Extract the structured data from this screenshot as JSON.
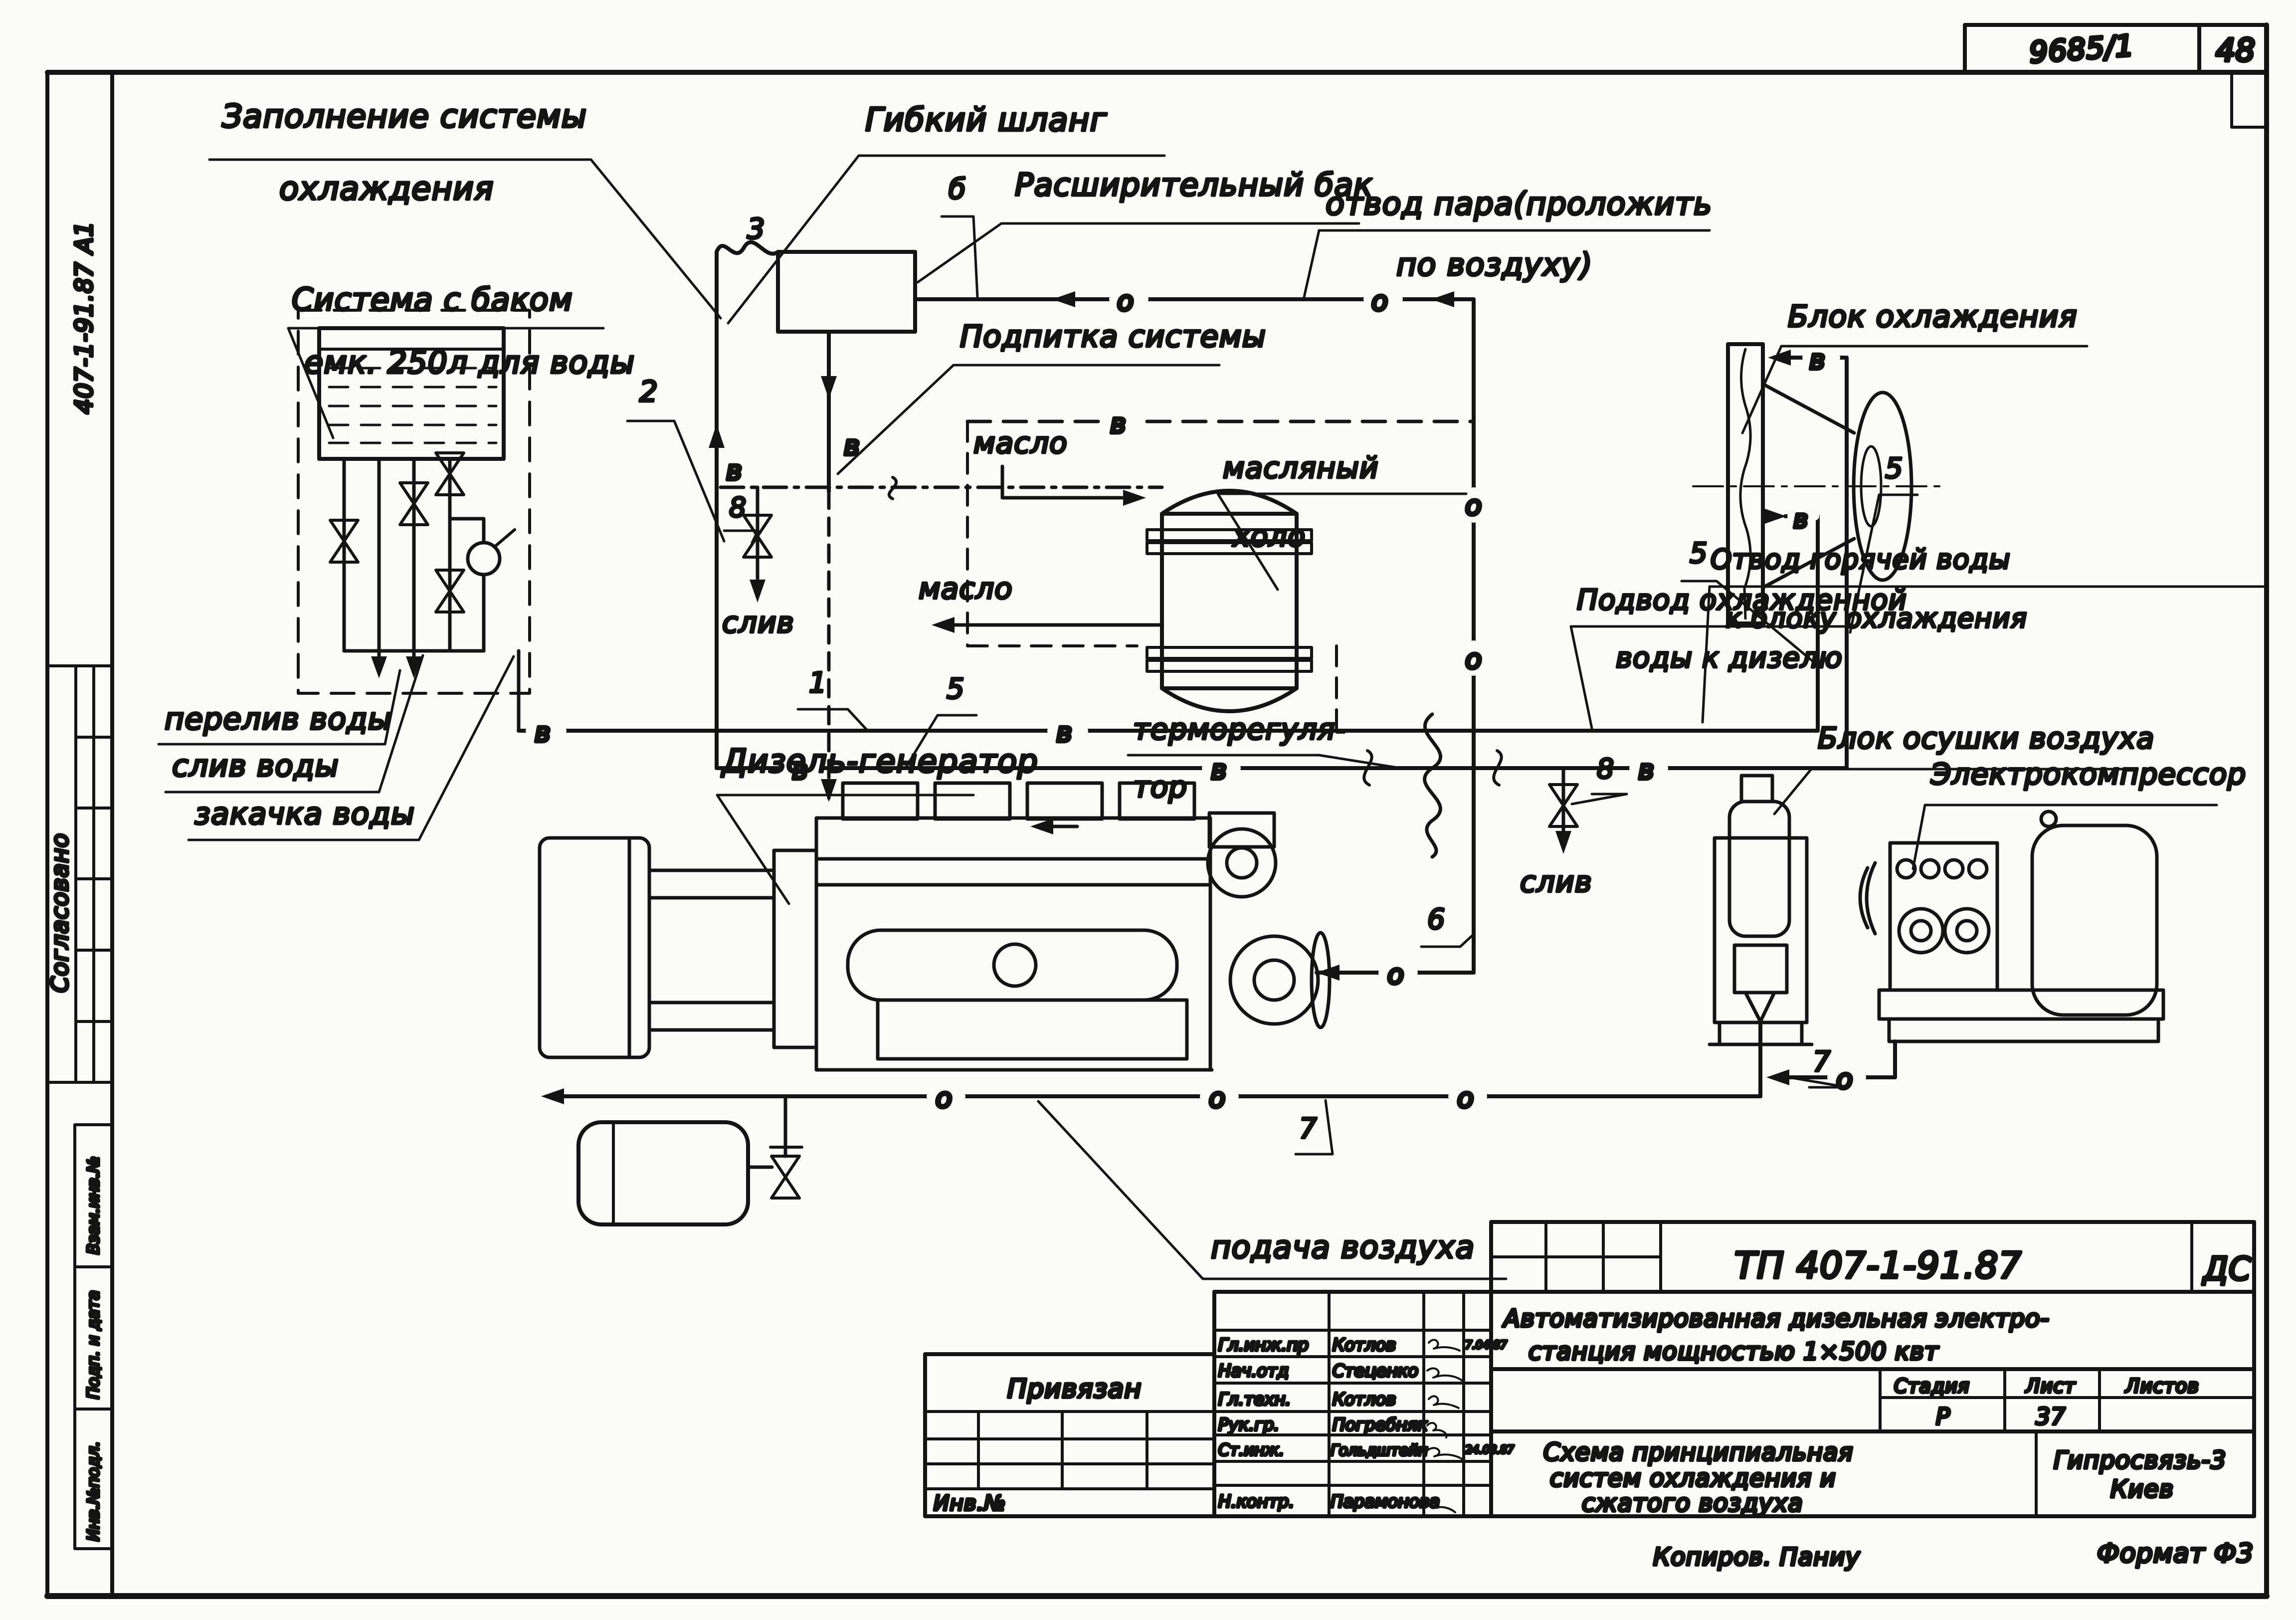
{
  "corner": {
    "doc": "9685/1",
    "sheet": "48"
  },
  "margin": {
    "code": "407-1-91.87   А1",
    "agreed": "Согласовано",
    "rows": [
      "Взам.инв.№",
      "Подп. и дата",
      "Инв.№подл."
    ]
  },
  "labels": {
    "fill1": "Заполнение системы",
    "fill2": "охлаждения",
    "tank1": "Система с баком",
    "tank2": "емк. 250л для воды",
    "hose": "Гибкий шланг",
    "exp_tank": "Расширительный бак",
    "steam1": "отвод пара(проложить",
    "steam2": "по воздуху)",
    "makeup": "Подпитка системы",
    "oil_in": "масло",
    "oil_cooler1": "масляный",
    "oil_cooler2": "холо",
    "oil_out": "масло",
    "drain_left": "слив",
    "drain_mid": "слив",
    "overflow": "перелив воды",
    "drain_tank": "слив воды",
    "fill_pump": "закачка воды",
    "diesel": "Дизель-генератор",
    "thermo1": "терморегуля-",
    "thermo2": "тор",
    "cool_block": "Блок охлаждения",
    "cooled_in1": "Подвод охлажденной",
    "cooled_in2": "воды к дизелю",
    "hot_out1": "Отвод горячей воды",
    "hot_out2": "к блоку охлаждения",
    "dryer": "Блок осушки воздуха",
    "compressor": "Электрокомпрессор",
    "air_supply": "подача воздуха"
  },
  "letters": {
    "v": "в",
    "o": "о",
    "b": "б"
  },
  "numbers": {
    "n1": "1",
    "n2": "2",
    "n3": "3",
    "n5": "5",
    "n6": "6",
    "n7": "7",
    "n8": "8"
  },
  "title_block": {
    "code": "ТП 407-1-91.87",
    "type": "ДС",
    "project1": "Автоматизированная  дизельная  электро-",
    "project2": "станция    мощностью    1×500 квт",
    "stage_h": "Стадия",
    "sheet_h": "Лист",
    "sheets_h": "Листов",
    "stage": "Р",
    "sheet": "37",
    "sheets": "",
    "name1": "Схема принципиальная",
    "name2": "систем охлаждения и",
    "name3": "сжатого воздуха",
    "org1": "Гипросвязь-3",
    "org2": "Киев",
    "bound": "Привязан",
    "inv": "Инв.№",
    "copier": "Копиров. Паниу",
    "format": "Формат Ф3",
    "sig_rows": [
      {
        "role": "Гл.инж.пр",
        "name": "Котлов",
        "date": "7.04.87"
      },
      {
        "role": "Нач.отд",
        "name": "Стеценко",
        "date": ""
      },
      {
        "role": "Гл.техн.",
        "name": "Котлов",
        "date": ""
      },
      {
        "role": "Рук.гр.",
        "name": "Погребняк",
        "date": ""
      },
      {
        "role": "Ст.инж.",
        "name": "Гольдштейн",
        "date": "24.08.87"
      },
      {
        "role": "Н.контр.",
        "name": "Парамонова",
        "date": ""
      }
    ]
  }
}
